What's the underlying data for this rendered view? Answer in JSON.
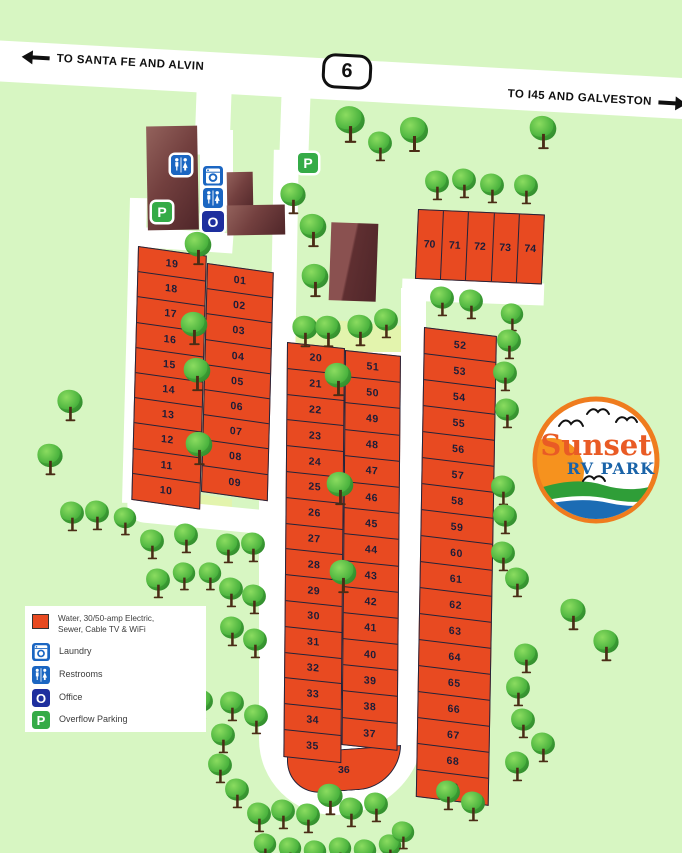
{
  "highway": {
    "route": "6",
    "left_label": "TO SANTA FE AND ALVIN",
    "right_label": "TO I45 AND GALVESTON"
  },
  "logo": {
    "name": "Sunset",
    "sub": "RV PARK"
  },
  "signs": {
    "parking": "P",
    "office": "O"
  },
  "legend": {
    "lot_label": "Water, 30/50-amp Electric, Sewer, Cable TV & WiFi",
    "laundry": "Laundry",
    "restrooms": "Restrooms",
    "office": "Office",
    "parking": "Overflow Parking"
  },
  "lots": {
    "left_outer": [
      "19",
      "18",
      "17",
      "16",
      "15",
      "14",
      "13",
      "12",
      "11",
      "10"
    ],
    "left_inner": [
      "01",
      "02",
      "03",
      "04",
      "05",
      "06",
      "07",
      "08",
      "09"
    ],
    "mid_left": [
      "20",
      "21",
      "22",
      "23",
      "24",
      "25",
      "26",
      "27",
      "28",
      "29",
      "30",
      "31",
      "32",
      "33",
      "34",
      "35"
    ],
    "mid_right": [
      "51",
      "50",
      "49",
      "48",
      "47",
      "46",
      "45",
      "44",
      "43",
      "42",
      "41",
      "40",
      "39",
      "38",
      "37"
    ],
    "mid_bottom": "36",
    "right_col": [
      "52",
      "53",
      "54",
      "55",
      "56",
      "57",
      "58",
      "59",
      "60",
      "61",
      "62",
      "63",
      "64",
      "65",
      "66",
      "67",
      "68",
      "69"
    ],
    "top_right": [
      "70",
      "71",
      "72",
      "73",
      "74"
    ]
  },
  "trees": [
    [
      335,
      108,
      1.05
    ],
    [
      365,
      126,
      0.85
    ],
    [
      399,
      117,
      1.0
    ],
    [
      528,
      114,
      0.95
    ],
    [
      422,
      165,
      0.85
    ],
    [
      449,
      163,
      0.85
    ],
    [
      477,
      168,
      0.85
    ],
    [
      511,
      169,
      0.85
    ],
    [
      278,
      179,
      0.9
    ],
    [
      298,
      212,
      0.95
    ],
    [
      300,
      262,
      0.95
    ],
    [
      290,
      312,
      0.9
    ],
    [
      313,
      312,
      0.9
    ],
    [
      345,
      311,
      0.9
    ],
    [
      371,
      303,
      0.85
    ],
    [
      183,
      230,
      0.95
    ],
    [
      179,
      310,
      0.95
    ],
    [
      182,
      356,
      0.95
    ],
    [
      184,
      430,
      0.95
    ],
    [
      323,
      361,
      0.95
    ],
    [
      325,
      470,
      0.95
    ],
    [
      328,
      558,
      0.95
    ],
    [
      55,
      386,
      0.9
    ],
    [
      35,
      440,
      0.9
    ],
    [
      57,
      496,
      0.85
    ],
    [
      82,
      495,
      0.85
    ],
    [
      110,
      500,
      0.8
    ],
    [
      137,
      524,
      0.85
    ],
    [
      171,
      518,
      0.85
    ],
    [
      213,
      528,
      0.85
    ],
    [
      238,
      527,
      0.85
    ],
    [
      143,
      563,
      0.85
    ],
    [
      169,
      555,
      0.8
    ],
    [
      195,
      555,
      0.8
    ],
    [
      216,
      572,
      0.85
    ],
    [
      239,
      579,
      0.85
    ],
    [
      217,
      611,
      0.85
    ],
    [
      240,
      623,
      0.85
    ],
    [
      186,
      684,
      0.85
    ],
    [
      217,
      686,
      0.85
    ],
    [
      241,
      699,
      0.85
    ],
    [
      208,
      718,
      0.85
    ],
    [
      205,
      748,
      0.85
    ],
    [
      222,
      773,
      0.85
    ],
    [
      244,
      797,
      0.85
    ],
    [
      268,
      794,
      0.85
    ],
    [
      293,
      798,
      0.85
    ],
    [
      315,
      780,
      0.9
    ],
    [
      336,
      792,
      0.85
    ],
    [
      361,
      787,
      0.85
    ],
    [
      250,
      826,
      0.8
    ],
    [
      275,
      830,
      0.8
    ],
    [
      300,
      833,
      0.8
    ],
    [
      325,
      830,
      0.8
    ],
    [
      350,
      832,
      0.8
    ],
    [
      375,
      827,
      0.8
    ],
    [
      388,
      814,
      0.8
    ],
    [
      433,
      775,
      0.85
    ],
    [
      458,
      786,
      0.85
    ],
    [
      427,
      281,
      0.85
    ],
    [
      456,
      284,
      0.85
    ],
    [
      497,
      296,
      0.8
    ],
    [
      494,
      324,
      0.85
    ],
    [
      490,
      356,
      0.85
    ],
    [
      492,
      393,
      0.85
    ],
    [
      488,
      470,
      0.85
    ],
    [
      490,
      499,
      0.85
    ],
    [
      488,
      536,
      0.85
    ],
    [
      502,
      562,
      0.85
    ],
    [
      511,
      638,
      0.85
    ],
    [
      503,
      671,
      0.85
    ],
    [
      508,
      703,
      0.85
    ],
    [
      528,
      727,
      0.85
    ],
    [
      502,
      746,
      0.85
    ],
    [
      558,
      595,
      0.9
    ],
    [
      591,
      626,
      0.9
    ]
  ],
  "colors": {
    "background": "#d7f6c2",
    "lot": "#e84a21",
    "road": "#ffffff",
    "sign_blue": "#1b66c2",
    "office_blue": "#1e2f9e",
    "sign_green": "#35ab47",
    "logo_orange": "#ef7c1e",
    "logo_text_blue": "#1a63a8"
  }
}
